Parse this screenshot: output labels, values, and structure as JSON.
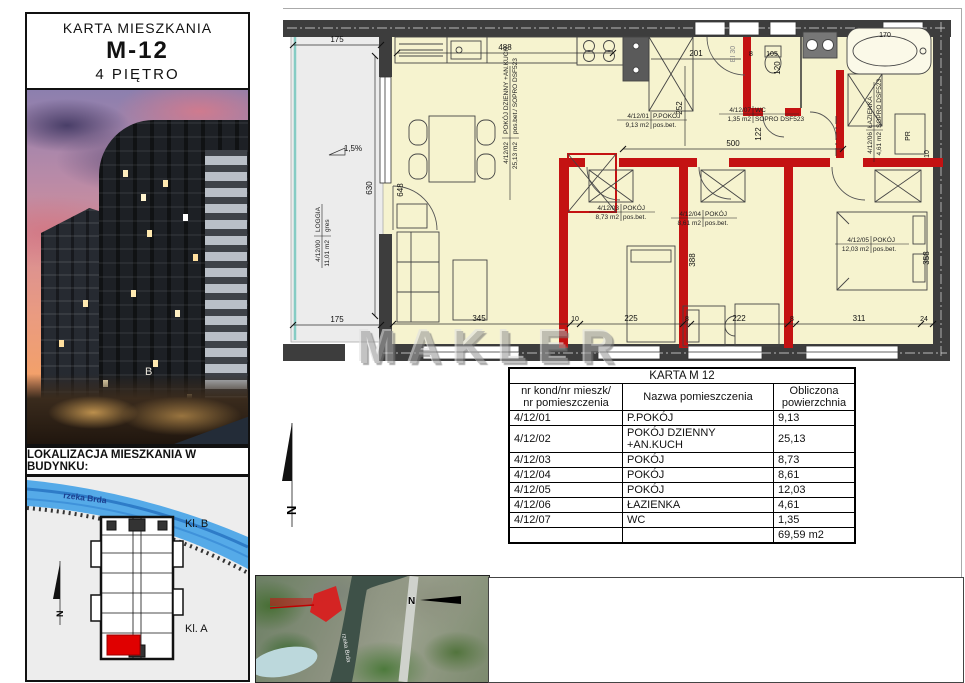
{
  "header": {
    "title": "KARTA MIESZKANIA",
    "unit": "M-12",
    "floor": "4 PIĘTRO"
  },
  "photo": {
    "building_letter": "B"
  },
  "location": {
    "heading": "LOKALIZACJA MIESZKANIA W BUDYNKU:",
    "river_label": "rzeka Brda",
    "stair_b": "Kl. B",
    "stair_a": "Kl. A",
    "north": "N"
  },
  "watermark": "MAKLER",
  "plan": {
    "north": "N",
    "entry_door_class": "EI 30",
    "washer": "PR",
    "tub_length": "170",
    "rooms": [
      {
        "id": "4/12/00",
        "name": "LOGGIA",
        "area": "11,01 m2",
        "floor": "gres"
      },
      {
        "id": "4/12/01",
        "name": "P.POKÓJ",
        "area": "9,13 m2",
        "floor": "pos.bet."
      },
      {
        "id": "4/12/02",
        "name": "POKÓJ DZIENNY +AN.KUCH",
        "area": "25,13 m2",
        "floor": "pos.bet./ SOPRO DSF523"
      },
      {
        "id": "4/12/03",
        "name": "POKÓJ",
        "area": "8,73 m2",
        "floor": "pos.bet."
      },
      {
        "id": "4/12/04",
        "name": "POKÓJ",
        "area": "8,61 m2",
        "floor": "pos.bet."
      },
      {
        "id": "4/12/05",
        "name": "POKÓJ",
        "area": "12,03 m2",
        "floor": "pos.bet."
      },
      {
        "id": "4/12/06",
        "name": "ŁAZIENKA",
        "area": "4,61 m2",
        "floor": "SOPRO DSF523"
      },
      {
        "id": "4/12/07",
        "name": "WC",
        "area": "1,35 m2",
        "floor": "SOPRO DSF523"
      }
    ],
    "dims": {
      "loggia_width_top": "175",
      "loggia_width_bottom": "175",
      "loggia_height": "630",
      "loggia_slope": "1,5%",
      "kitchen_width": "488",
      "hall_width": "201",
      "d8_1": "8",
      "d105": "105",
      "corridor_width": "500",
      "d252": "252",
      "d122": "122",
      "d120": "120",
      "d648": "648",
      "d345": "345",
      "d10": "10",
      "d225": "225",
      "d8_2": "8",
      "d222": "222",
      "d8_3": "8",
      "d311": "311",
      "d24": "24",
      "d388": "388",
      "d358": "358",
      "d10_2": "10"
    }
  },
  "table": {
    "title": "KARTA M 12",
    "headers": [
      "nr kond/nr mieszk/\nnr pomieszczenia",
      "Nazwa pomieszczenia",
      "Obliczona\npowierzchnia"
    ],
    "rows": [
      [
        "4/12/01",
        "P.POKÓJ",
        "9,13"
      ],
      [
        "4/12/02",
        "POKÓJ DZIENNY\n+AN.KUCH",
        "25,13"
      ],
      [
        "4/12/03",
        "POKÓJ",
        "8,73"
      ],
      [
        "4/12/04",
        "POKÓJ",
        "8,61"
      ],
      [
        "4/12/05",
        "POKÓJ",
        "12,03"
      ],
      [
        "4/12/06",
        "ŁAZIENKA",
        "4,61"
      ],
      [
        "4/12/07",
        "WC",
        "1,35"
      ],
      [
        "",
        "",
        "69,59 m2"
      ]
    ]
  },
  "aerial": {
    "river_label": "rzeka Brda",
    "north": "N"
  },
  "colors": {
    "wall": "#3d3d3d",
    "partition_red": "#c41212",
    "floor_fill": "#f6f3cf",
    "loggia_fill": "#ececec",
    "river_blue": "#55aae8",
    "unit_highlight": "#e00000"
  }
}
